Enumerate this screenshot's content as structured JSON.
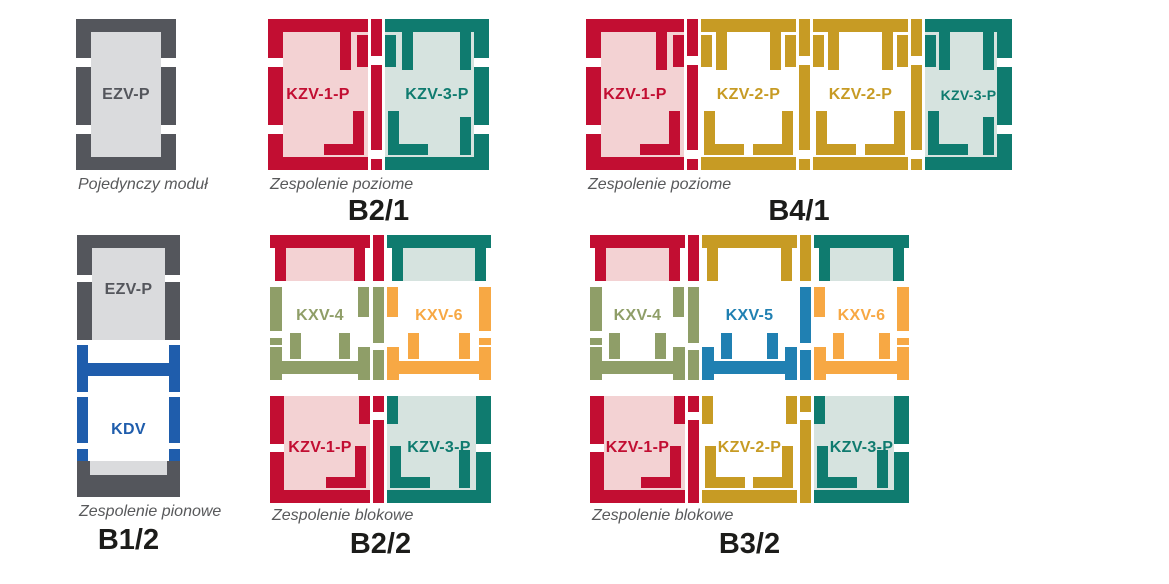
{
  "colors": {
    "red": "#c20e32",
    "redTint": "#f3d2d3",
    "teal": "#0f7b6f",
    "tealTint": "#d6e3df",
    "gold": "#c79b24",
    "olive": "#8f9e68",
    "orange": "#f7a844",
    "blue": "#1f5dac",
    "blueLight": "#2080b2",
    "gray": "#54565c",
    "grayTint": "#dadbdd",
    "caption": "#58595b",
    "title": "#1c1c1a"
  },
  "panels": {
    "single": {
      "caption": "Pojedynczy moduł",
      "modules": [
        {
          "label": "EZV-P"
        }
      ]
    },
    "b21": {
      "caption": "Zespolenie poziome",
      "title": "B2/1",
      "modules": [
        {
          "label": "KZV-1-P"
        },
        {
          "label": "KZV-3-P"
        }
      ]
    },
    "b41": {
      "caption": "Zespolenie poziome",
      "title": "B4/1",
      "modules": [
        {
          "label": "KZV-1-P"
        },
        {
          "label": "KZV-2-P"
        },
        {
          "label": "KZV-2-P"
        },
        {
          "label": "KZV-3-P"
        }
      ]
    },
    "b12": {
      "caption": "Zespolenie pionowe",
      "title": "B1/2",
      "modules": [
        {
          "label": "EZV-P"
        },
        {
          "label": "KDV"
        }
      ]
    },
    "b22": {
      "caption": "Zespolenie blokowe",
      "title": "B2/2",
      "top_modules": [
        {
          "label": "KXV-4"
        },
        {
          "label": "KXV-6"
        }
      ],
      "bottom_modules": [
        {
          "label": "KZV-1-P"
        },
        {
          "label": "KZV-3-P"
        }
      ]
    },
    "b32": {
      "caption": "Zespolenie blokowe",
      "title": "B3/2",
      "top_modules": [
        {
          "label": "KXV-4"
        },
        {
          "label": "KXV-5"
        },
        {
          "label": "KXV-6"
        }
      ],
      "bottom_modules": [
        {
          "label": "KZV-1-P"
        },
        {
          "label": "KZV-2-P"
        },
        {
          "label": "KZV-3-P"
        }
      ]
    }
  }
}
